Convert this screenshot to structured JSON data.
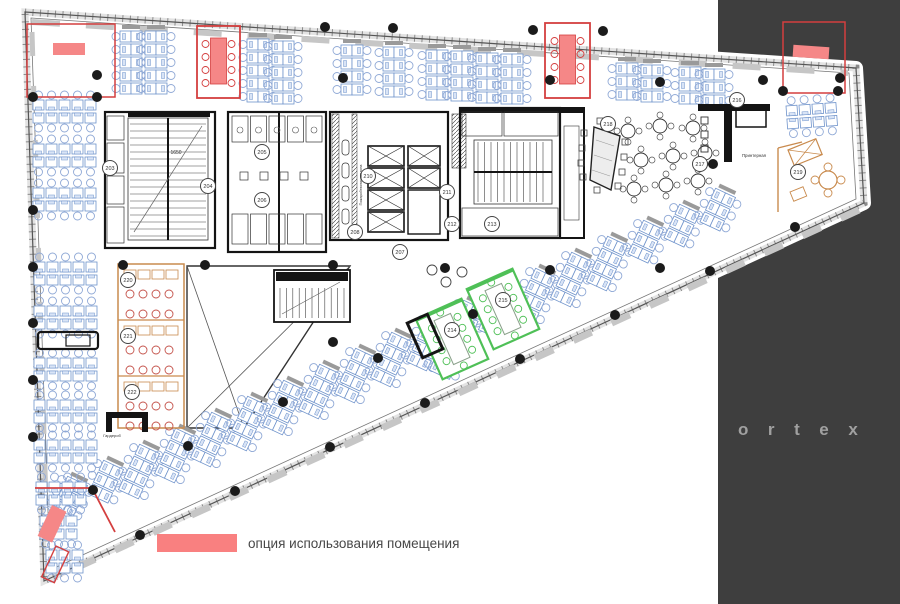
{
  "side_panel": {
    "color": "#3e3e3e",
    "x": 718,
    "brand_text": "ortex",
    "letter_color": "#a0a0a0"
  },
  "legend": {
    "swatch_color": "#f98080",
    "label": "опция использования помещения",
    "text_color": "#474747"
  },
  "plan": {
    "colors": {
      "blue": "#6f93cb",
      "blueLight": "#d9e4f6",
      "chair": "#90a9d6",
      "cap": "#9a9a9a",
      "red": "#d43f3f",
      "redFill": "#f58787",
      "orange": "#c98b4e",
      "orangeChair": "#c4524a",
      "green": "#4fc057",
      "table": "#8aa08a",
      "wall": "#141414",
      "line": "#555555",
      "facade": "#e3e3e3",
      "tick": "#8a8a8a",
      "slab": "#c6c6c6",
      "dot": "#1b1b1b",
      "tag": "#444444"
    },
    "outline": [
      [
        25,
        12
      ],
      [
        856,
        68
      ],
      [
        864,
        203
      ],
      [
        44,
        581
      ]
    ],
    "inner_outline": [
      [
        31,
        18
      ],
      [
        849,
        73
      ],
      [
        856,
        199
      ],
      [
        50,
        570
      ]
    ],
    "slabs": [
      {
        "pts": [
          [
            32,
            22
          ],
          [
            848,
            73
          ]
        ],
        "w": 6,
        "dash": "28 26"
      },
      {
        "pts": [
          [
            859,
            210
          ],
          [
            56,
            577
          ]
        ],
        "w": 7,
        "dash": "20 22"
      },
      {
        "pts": [
          [
            32,
            32
          ],
          [
            48,
            570
          ]
        ],
        "w": 5,
        "dash": "24 30"
      }
    ],
    "columns": [
      [
        97,
        75
      ],
      [
        343,
        78
      ],
      [
        550,
        80
      ],
      [
        660,
        82
      ],
      [
        763,
        80
      ],
      [
        840,
        78
      ],
      [
        325,
        27
      ],
      [
        393,
        28
      ],
      [
        533,
        30
      ],
      [
        603,
        31
      ],
      [
        123,
        265
      ],
      [
        205,
        265
      ],
      [
        333,
        265
      ],
      [
        445,
        268
      ],
      [
        550,
        270
      ],
      [
        660,
        268
      ],
      [
        33,
        97
      ],
      [
        33,
        210
      ],
      [
        33,
        267
      ],
      [
        33,
        323
      ],
      [
        33,
        380
      ],
      [
        33,
        437
      ],
      [
        93,
        490
      ],
      [
        188,
        446
      ],
      [
        283,
        402
      ],
      [
        378,
        358
      ],
      [
        473,
        314
      ],
      [
        140,
        535
      ],
      [
        235,
        491
      ],
      [
        330,
        447
      ],
      [
        425,
        403
      ],
      [
        520,
        359
      ],
      [
        615,
        315
      ],
      [
        710,
        271
      ],
      [
        795,
        227
      ],
      [
        783,
        91
      ],
      [
        838,
        91
      ],
      [
        713,
        164
      ],
      [
        333,
        342
      ],
      [
        97,
        97
      ]
    ],
    "top_clusters": [
      [
        131,
        30,
        5
      ],
      [
        156,
        30,
        5
      ],
      [
        258,
        38,
        5
      ],
      [
        283,
        40,
        5
      ],
      [
        352,
        44,
        4
      ],
      [
        394,
        46,
        4
      ],
      [
        437,
        49,
        4
      ],
      [
        462,
        50,
        4
      ],
      [
        487,
        52,
        4
      ],
      [
        512,
        53,
        4
      ],
      [
        627,
        62,
        3
      ],
      [
        652,
        64,
        3
      ],
      [
        690,
        66,
        3
      ],
      [
        714,
        68,
        3
      ]
    ],
    "lane": {
      "x0": 78,
      "y0": 480,
      "dx": 36,
      "dy": -16,
      "count": 19,
      "skip": [
        10,
        11,
        12
      ],
      "rot": 25
    },
    "extra_slant": [
      [
        450,
        352,
        2
      ]
    ],
    "hblocks": [
      [
        33,
        100,
        5
      ],
      [
        33,
        144,
        5
      ],
      [
        33,
        188,
        5
      ],
      [
        34,
        262,
        5
      ],
      [
        34,
        306,
        5
      ],
      [
        34,
        358,
        5
      ],
      [
        34,
        400,
        5
      ],
      [
        34,
        440,
        5
      ],
      [
        36,
        482,
        4
      ],
      [
        40,
        516,
        3
      ],
      [
        46,
        550,
        3
      ]
    ],
    "under_red_rows": {
      "x": 786,
      "y": 106,
      "n": 4,
      "rot": -4
    },
    "atrium": {
      "poly": [
        [
          187,
          266
        ],
        [
          350,
          266
        ],
        [
          244,
          428
        ],
        [
          187,
          428
        ]
      ],
      "x1": [
        [
          187,
          266
        ],
        [
          244,
          428
        ]
      ],
      "x2": [
        [
          350,
          266
        ],
        [
          187,
          428
        ]
      ]
    },
    "stair_f": [
      274,
      270,
      76,
      52
    ],
    "red": {
      "tl_room": [
        27,
        24,
        88,
        73
      ],
      "tl_table": [
        53,
        43,
        32,
        12
      ],
      "room1": [
        197,
        26,
        43,
        72
      ],
      "room2": [
        545,
        23,
        45,
        75
      ],
      "tr_room": [
        783,
        22,
        62,
        71
      ],
      "tr_table": [
        793,
        46,
        36,
        12
      ],
      "lines": [
        [
          [
            35,
            488
          ],
          [
            93,
            488
          ]
        ],
        [
          [
            93,
            490
          ],
          [
            115,
            532
          ]
        ]
      ],
      "pink_block": {
        "x": 52,
        "y": 505,
        "w": 16,
        "h": 34,
        "rot": 25
      },
      "tip_outline": {
        "x": 56,
        "y": 546,
        "w": 14,
        "h": 34,
        "rot": 25
      }
    },
    "orange": {
      "zone": [
        118,
        264,
        66,
        164
      ],
      "dividers": [
        320,
        376
      ],
      "corner": {
        "lines": [
          [
            [
              778,
              148
            ],
            [
              778,
              212
            ]
          ],
          [
            [
              778,
              148
            ],
            [
              802,
              142
            ]
          ]
        ],
        "xtable": [
          788,
          150,
          30,
          17,
          -22
        ],
        "round_table": [
          828,
          180
        ],
        "small": [
          790,
          192,
          14,
          10,
          -22
        ]
      }
    },
    "green_rooms": [
      {
        "cx": 452,
        "cy": 339
      },
      {
        "cx": 503,
        "cy": 309
      }
    ],
    "green_size": {
      "w": 50,
      "h": 66,
      "rot": -24
    },
    "black_rect": {
      "cx": 425,
      "cy": 336,
      "w": 22,
      "h": 38,
      "rot": -24
    },
    "cafe": {
      "tables": [
        [
          628,
          131
        ],
        [
          660,
          126
        ],
        [
          693,
          128
        ],
        [
          641,
          160
        ],
        [
          673,
          156
        ],
        [
          705,
          153
        ],
        [
          634,
          189
        ],
        [
          666,
          185
        ],
        [
          698,
          181
        ]
      ],
      "trapezoid": [
        [
          594,
          127
        ],
        [
          620,
          136
        ],
        [
          611,
          190
        ],
        [
          590,
          180
        ]
      ],
      "chairs": [
        [
          584,
          133
        ],
        [
          582,
          148
        ],
        [
          581,
          163
        ],
        [
          583,
          177
        ],
        [
          600,
          121
        ],
        [
          612,
          124
        ],
        [
          625,
          142
        ],
        [
          624,
          157
        ],
        [
          622,
          172
        ],
        [
          618,
          186
        ],
        [
          597,
          190
        ]
      ]
    },
    "bar": {
      "walls": [
        [
          698,
          104,
          72,
          7
        ],
        [
          724,
          104,
          8,
          58
        ]
      ],
      "counter": [
        736,
        110,
        30,
        17
      ],
      "stools": [
        [
          704,
          120
        ],
        [
          704,
          134
        ],
        [
          704,
          148
        ]
      ]
    },
    "truck": [
      38,
      332,
      60,
      17
    ],
    "wardrobe_black": [
      [
        106,
        412,
        42,
        6
      ],
      [
        106,
        418,
        6,
        14
      ],
      [
        142,
        418,
        6,
        14
      ]
    ],
    "lounge": [
      [
        432,
        270
      ],
      [
        446,
        282
      ],
      [
        462,
        272
      ]
    ],
    "tags": [
      [
        110,
        168,
        "203"
      ],
      [
        208,
        186,
        "204"
      ],
      [
        262,
        152,
        "205"
      ],
      [
        262,
        200,
        "206"
      ],
      [
        400,
        252,
        "207"
      ],
      [
        355,
        232,
        "208"
      ],
      [
        368,
        176,
        "210"
      ],
      [
        447,
        192,
        "211"
      ],
      [
        452,
        224,
        "212"
      ],
      [
        492,
        224,
        "213"
      ],
      [
        452,
        330,
        "214"
      ],
      [
        503,
        300,
        "215"
      ],
      [
        737,
        100,
        "216"
      ],
      [
        700,
        164,
        "217"
      ],
      [
        608,
        124,
        "218"
      ],
      [
        798,
        172,
        "219"
      ],
      [
        128,
        280,
        "220"
      ],
      [
        128,
        336,
        "221"
      ],
      [
        132,
        392,
        "222"
      ]
    ],
    "texts": {
      "printer_room": {
        "label": "Принтерная",
        "x": 740,
        "y": 157,
        "size": 4.3
      },
      "wardrobe": {
        "label": "Гардероб",
        "x": 100,
        "y": 437,
        "size": 4
      },
      "dim": {
        "label": "1650",
        "x": 176,
        "y": 154,
        "size": 5
      },
      "fire_zone": {
        "label": "Пожаробезопасная зона",
        "x": 362,
        "y": 185,
        "size": 3.6,
        "rot": -90
      }
    }
  }
}
